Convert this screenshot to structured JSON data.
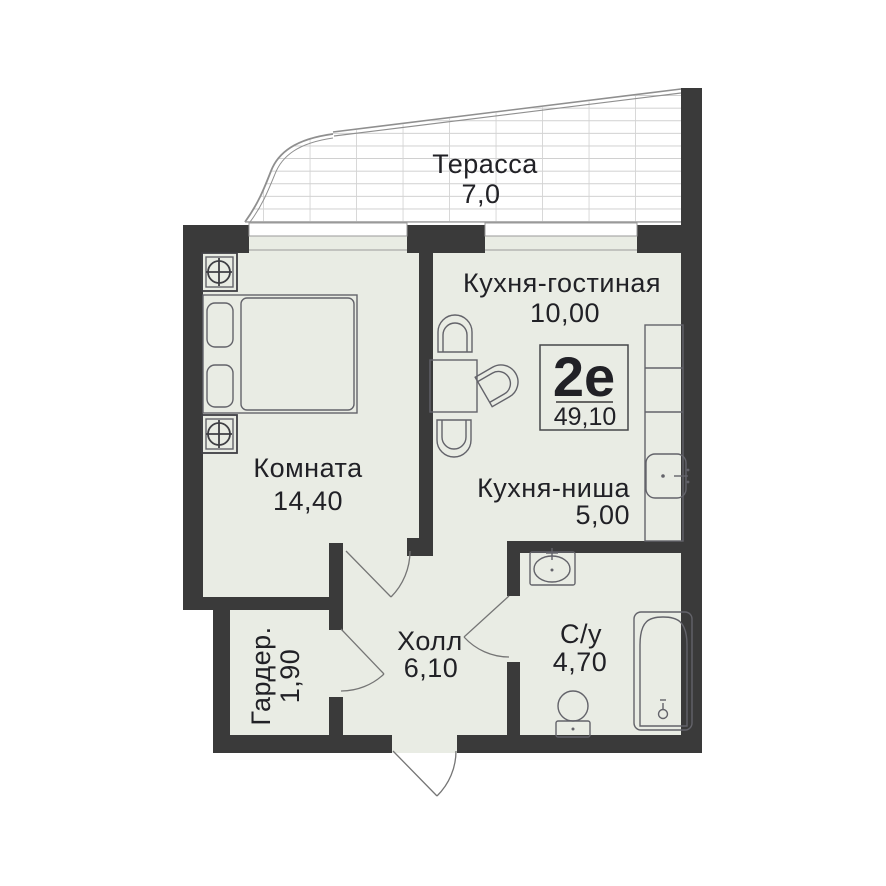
{
  "plan_title": "Floor plan 2e apartment",
  "badge": {
    "type": "2е",
    "total_area": "49,10"
  },
  "terrace": {
    "name": "Терасса",
    "area": "7,0"
  },
  "rooms": {
    "kitchen_living": {
      "name": "Кухня-гостиная",
      "area": "10,00"
    },
    "bedroom": {
      "name": "Комната",
      "area": "14,40"
    },
    "kitchen_niche": {
      "name": "Кухня-ниша",
      "area": "5,00"
    },
    "hall": {
      "name": "Холл",
      "area": "6,10"
    },
    "bathroom": {
      "name": "С/у",
      "area": "4,70"
    },
    "wardrobe": {
      "name": "Гардер.",
      "area": "1,90"
    }
  },
  "colors": {
    "wall": "#3a3a3a",
    "floor": "#e9ece4",
    "background": "#ffffff",
    "terrace_hatch": "#c9c9c9",
    "text": "#212126"
  }
}
